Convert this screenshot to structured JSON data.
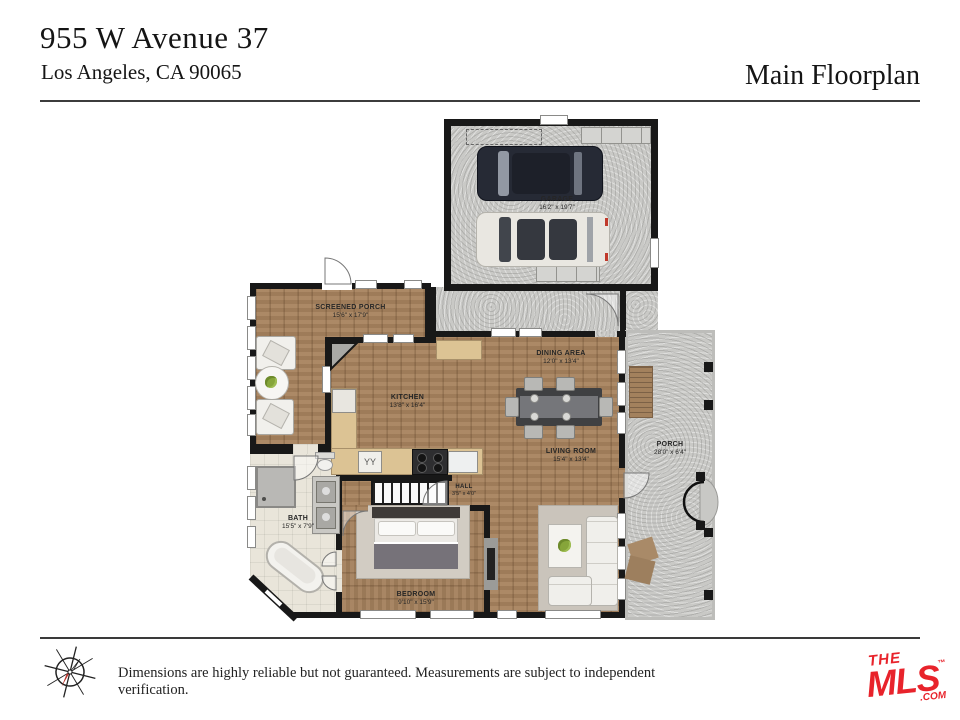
{
  "header": {
    "address_line1": "955 W Avenue 37",
    "address_line2": "Los Angeles, CA 90065",
    "title": "Main Floorplan"
  },
  "rooms": {
    "garage": {
      "name": "GARAGE",
      "dims": "16'2\" x 19'7\""
    },
    "screened_porch": {
      "name": "SCREENED PORCH",
      "dims": "15'6\" x 17'9\""
    },
    "kitchen": {
      "name": "KITCHEN",
      "dims": "13'8\" x 16'4\""
    },
    "dining_area": {
      "name": "DINING AREA",
      "dims": "12'0\" x 13'4\""
    },
    "living_room": {
      "name": "LIVING ROOM",
      "dims": "15'4\" x 13'4\""
    },
    "porch": {
      "name": "PORCH",
      "dims": "28'0\" x 6'4\""
    },
    "bath": {
      "name": "BATH",
      "dims": "15'5\" x 7'9\""
    },
    "hall": {
      "name": "HALL",
      "dims": "3'5\" x 4'0\""
    },
    "bedroom": {
      "name": "BEDROOM",
      "dims": "9'10\" x 15'9\""
    }
  },
  "footer": {
    "disclaimer": "Dimensions are highly reliable but not guaranteed. Measurements are subject to independent verification.",
    "logo": {
      "line1": "THE",
      "line2": "MLS",
      "trademark": "™",
      "suffix": ".COM"
    }
  },
  "colors": {
    "wall": "#181818",
    "wood_floor": "#a6825e",
    "concrete": "#c9c9c6",
    "tile": "#e9e5da",
    "counter": "#dcc394",
    "logo_red": "#e8232b"
  }
}
